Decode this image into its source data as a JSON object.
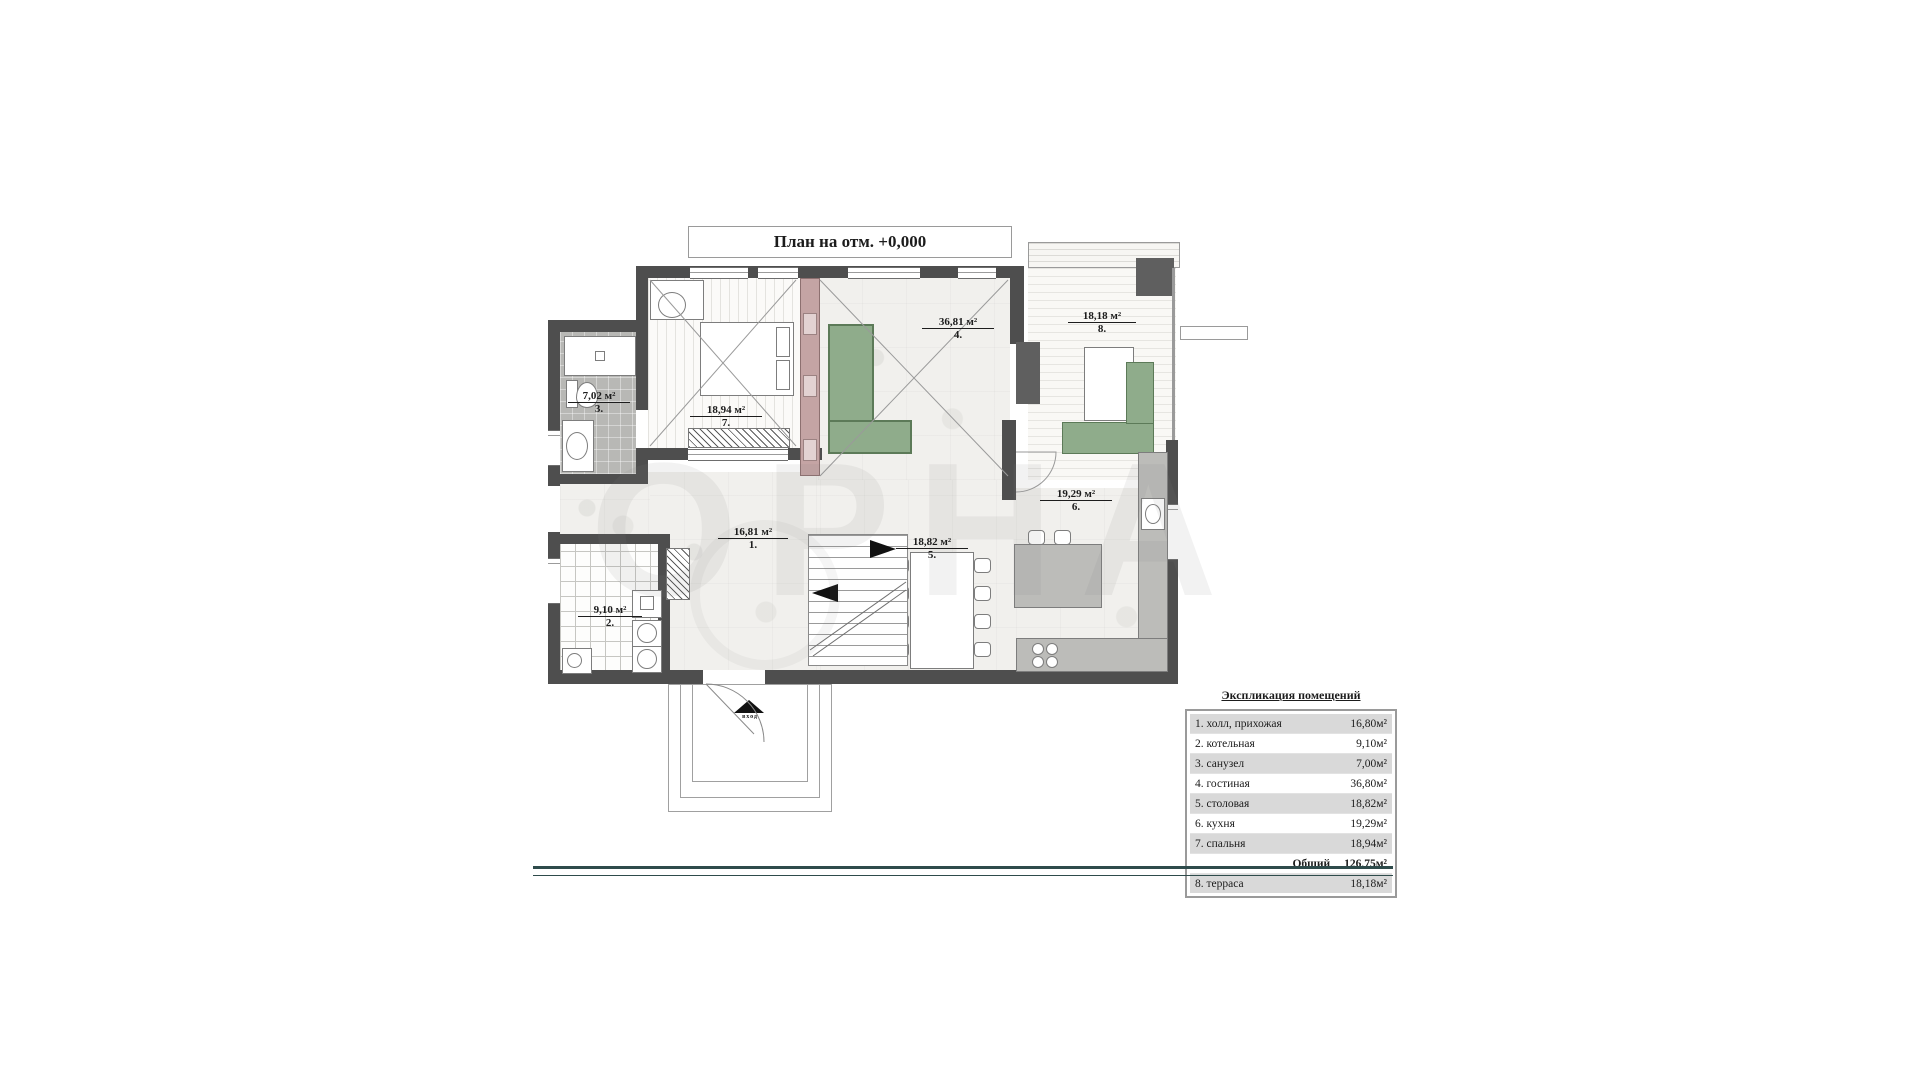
{
  "title": "План на отм. +0,000",
  "watermark": "ОРНА",
  "entry": {
    "label": "вход"
  },
  "plan": {
    "rooms": [
      {
        "id": "hall",
        "num": "1.",
        "area": "16,81 м²"
      },
      {
        "id": "boiler",
        "num": "2.",
        "area": "9,10 м²"
      },
      {
        "id": "bathroom",
        "num": "3.",
        "area": "7,02 м²"
      },
      {
        "id": "living",
        "num": "4.",
        "area": "36,81 м²"
      },
      {
        "id": "dining",
        "num": "5.",
        "area": "18,82 м²"
      },
      {
        "id": "kitchen",
        "num": "6.",
        "area": "19,29 м²"
      },
      {
        "id": "bedroom",
        "num": "7.",
        "area": "18,94 м²"
      },
      {
        "id": "terrace",
        "num": "8.",
        "area": "18,18 м²"
      }
    ]
  },
  "legend": {
    "header": "Экспликация помещений",
    "rows": [
      {
        "name": "1. холл, прихожая",
        "area": "16,80м²"
      },
      {
        "name": "2. котельная",
        "area": "9,10м²"
      },
      {
        "name": "3. санузел",
        "area": "7,00м²"
      },
      {
        "name": "4. гостиная",
        "area": "36,80м²"
      },
      {
        "name": "5. столовая",
        "area": "18,82м²"
      },
      {
        "name": "6. кухня",
        "area": "19,29м²"
      },
      {
        "name": "7. спальня",
        "area": "18,94м²"
      }
    ],
    "total_label": "Общий",
    "total_area": "126,75м²",
    "terrace_row": {
      "name": "8. терраса",
      "area": "18,18м²"
    }
  },
  "colors": {
    "wall": "#4e4e4e",
    "sofa_green": "#8fac8b",
    "closet_pink": "#c4a4a4",
    "bottom_rule": "#2e4b4b"
  }
}
